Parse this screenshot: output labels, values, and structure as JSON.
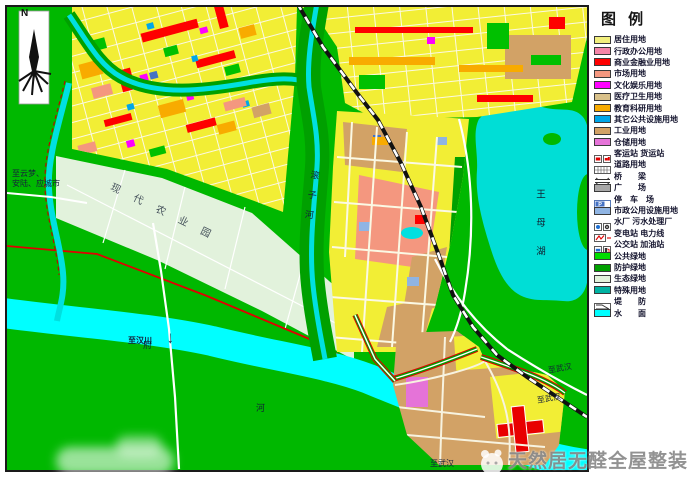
{
  "legend": {
    "title": "图 例",
    "items": [
      {
        "label": "居住用地",
        "color": "#f2ef7d"
      },
      {
        "label": "行政办公用地",
        "color": "#f585a8"
      },
      {
        "label": "商业金融业用地",
        "color": "#fe0000"
      },
      {
        "label": "市场用地",
        "color": "#f4977f"
      },
      {
        "label": "文化娱乐用地",
        "color": "#fe00fe"
      },
      {
        "label": "医疗卫生用地",
        "color": "#d9c18a"
      },
      {
        "label": "教育科研用地",
        "color": "#f8ab00"
      },
      {
        "label": "其它公共设施用地",
        "color": "#00a6e8"
      },
      {
        "label": "工业用地",
        "color": "#d2a266"
      },
      {
        "label": "仓储用地",
        "color": "#e573d8"
      },
      {
        "label": "客运站  货运站"
      },
      {
        "label": "道路用地"
      },
      {
        "label": "桥　　梁"
      },
      {
        "label": "广　　场",
        "color": "#a8a8a8"
      },
      {
        "label": "停　车　场"
      },
      {
        "label": "市政公用设施用地",
        "color": "#8fb4e3"
      },
      {
        "label": "水厂  污水处理厂"
      },
      {
        "label": "变电站  电力线"
      },
      {
        "label": "公交站  加油站"
      },
      {
        "label": "公共绿地",
        "color": "#00dc00"
      },
      {
        "label": "防护绿地",
        "color": "#00a000"
      },
      {
        "label": "生态绿地",
        "color": "#e2f2dc"
      },
      {
        "label": "特殊用地",
        "color": "#00b2a2"
      },
      {
        "label": "堤　　防"
      },
      {
        "label": "水　　面",
        "color": "#00ffff"
      }
    ]
  },
  "map": {
    "north_label": "N",
    "labels": {
      "to_yunmeng_line1": "至云梦、",
      "to_yunmeng_line2": "安陆、应城市",
      "to_hanchuan": "至汉川",
      "hanchuan_arrow": "↓",
      "fu_char": "府",
      "he_char": "河",
      "gunzi_river": "滚子河",
      "wangmu_lake": "王母湖",
      "to_wuhan_1": "至武汉",
      "to_wuhan_2": "至武汉",
      "to_wuhan_3": "至武汉",
      "agri_band": "现代农业园"
    },
    "colors": {
      "green_base": "#00b800",
      "protect_green": "#00a000",
      "eco_green": "#e2f2dc",
      "water": "#00ffff",
      "lake": "#00ded6",
      "residential": "#f2ee35",
      "industry": "#d2a266",
      "market": "#f4977f",
      "commercial": "#fe0000",
      "education": "#f8ab00",
      "culture": "#fe00fe",
      "warehouse": "#e573d8",
      "municipal": "#8fb4e3",
      "levee_line": "#e00000"
    }
  },
  "watermark": {
    "text": "天然居无醛全屋整装"
  }
}
